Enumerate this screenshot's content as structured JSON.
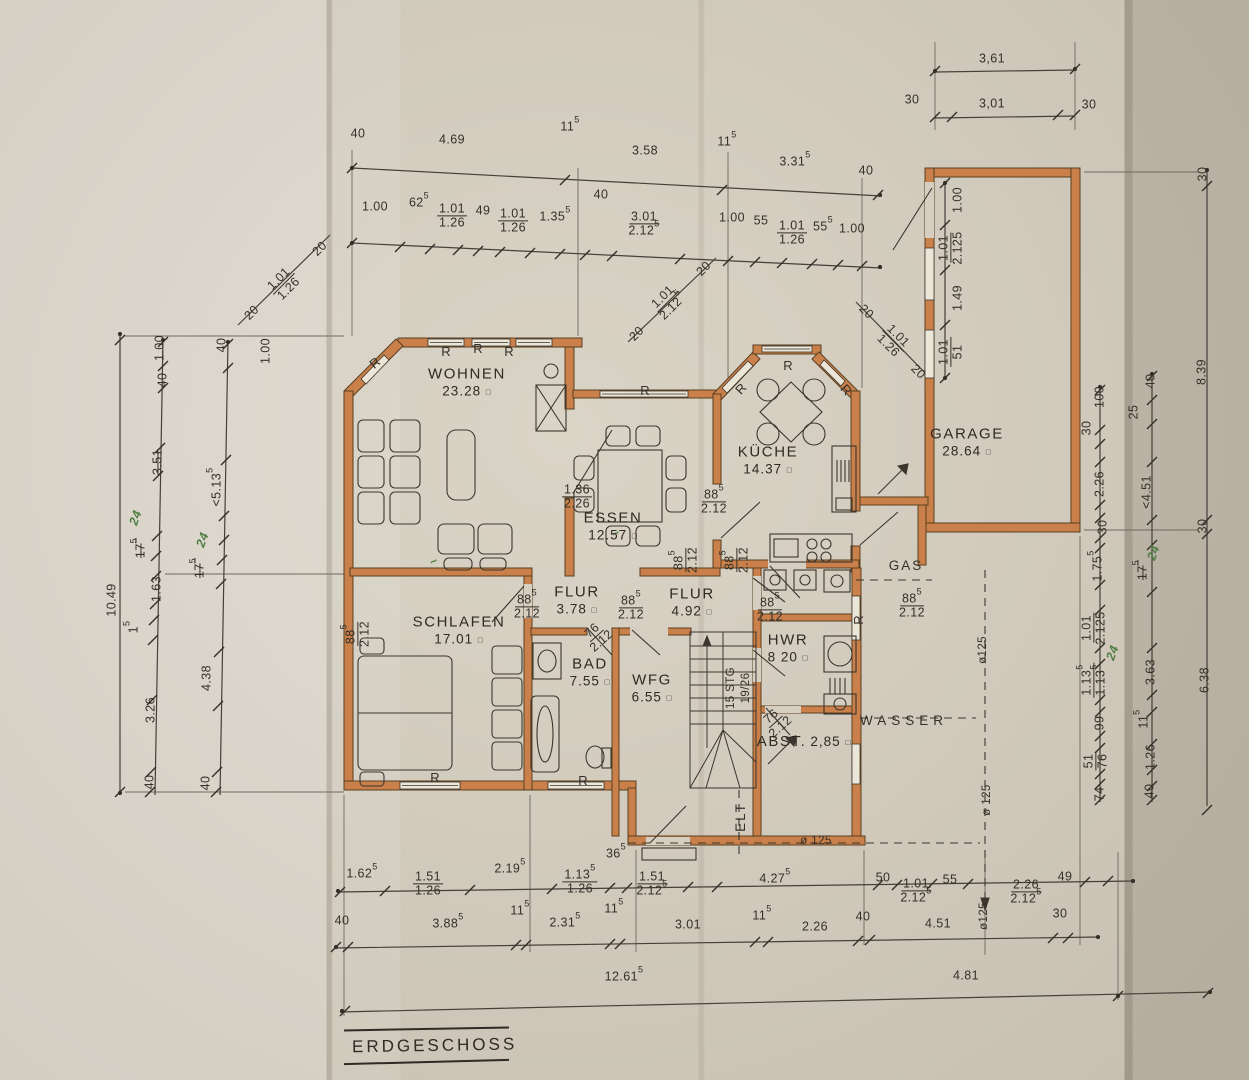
{
  "title": {
    "text": "ERDGESCHOSS"
  },
  "colors": {
    "paper": "#d6cfc1",
    "wall": "#c9804a",
    "wall_edge": "#5a4020",
    "ink": "#34302a",
    "hand_green": "#4e7d44"
  },
  "rooms": [
    {
      "n": "WOHNEN",
      "a": "23.28",
      "x": 467,
      "y": 382
    },
    {
      "n": "ESSEN",
      "a": "12.57",
      "x": 613,
      "y": 526
    },
    {
      "n": "KÜCHE",
      "a": "14.37",
      "x": 768,
      "y": 460
    },
    {
      "n": "GARAGE",
      "a": "28.64",
      "x": 967,
      "y": 442
    },
    {
      "n": "SCHLAFEN",
      "a": "17.01",
      "x": 459,
      "y": 630
    },
    {
      "n": "FLUR",
      "a": "3.78",
      "x": 577,
      "y": 600
    },
    {
      "n": "FLUR",
      "a": "4.92",
      "x": 692,
      "y": 602
    },
    {
      "n": "BAD",
      "a": "7.55",
      "x": 590,
      "y": 672
    },
    {
      "n": "WFG",
      "a": "6.55",
      "x": 652,
      "y": 688
    },
    {
      "n": "HWR",
      "a": "8 20",
      "x": 788,
      "y": 648
    },
    {
      "n": "ABST.",
      "a": "2,85",
      "x": 806,
      "y": 742,
      "inline": true
    }
  ],
  "dim_labels": [
    [
      "3,61",
      992,
      59
    ],
    [
      "30",
      912,
      100
    ],
    [
      "3,01",
      992,
      104
    ],
    [
      "30",
      1089,
      105
    ],
    [
      "40",
      358,
      134
    ],
    [
      "4.69",
      452,
      140
    ],
    [
      "11^5",
      570,
      127
    ],
    [
      "3.58",
      645,
      151
    ],
    [
      "11^5",
      727,
      142
    ],
    [
      "3.31^5",
      795,
      162
    ],
    [
      "40",
      866,
      171
    ],
    [
      "1.00",
      375,
      207
    ],
    [
      "62^5",
      419,
      203
    ],
    [
      "49",
      483,
      211
    ],
    [
      "1.35^5",
      555,
      217
    ],
    [
      "40",
      601,
      195
    ],
    [
      "1.00",
      732,
      218
    ],
    [
      "55",
      761,
      221
    ],
    [
      "55^5",
      823,
      227
    ],
    [
      "1.00",
      852,
      229
    ],
    [
      "1.00",
      958,
      200,
      -90
    ],
    [
      "1.49",
      958,
      298,
      -90
    ],
    [
      "10.49",
      112,
      600,
      -90
    ],
    [
      "1.00",
      160,
      348,
      -90
    ],
    [
      "40",
      163,
      380,
      -90
    ],
    [
      "3.51",
      158,
      462,
      -90,
      "strike"
    ],
    [
      "24",
      136,
      518,
      -70,
      "hand"
    ],
    [
      "17^5",
      141,
      548,
      -90,
      "strike"
    ],
    [
      "1.63",
      157,
      589,
      -90
    ],
    [
      "1^5",
      134,
      627,
      -90
    ],
    [
      "3.26",
      151,
      710,
      -90
    ],
    [
      "40",
      150,
      782,
      -90
    ],
    [
      "40",
      222,
      345,
      -90
    ],
    [
      "1.00",
      266,
      351,
      -90
    ],
    [
      "<5.13^5",
      217,
      487,
      -90
    ],
    [
      "24",
      203,
      540,
      -70,
      "hand"
    ],
    [
      "17^5",
      200,
      568,
      -90,
      "strike"
    ],
    [
      "4.38",
      207,
      678,
      -90
    ],
    [
      "40",
      206,
      783,
      -90
    ],
    [
      "100",
      1100,
      397,
      -90
    ],
    [
      "30",
      1087,
      428,
      -90
    ],
    [
      "2.26",
      1100,
      484,
      -90
    ],
    [
      "30",
      1103,
      527,
      -90
    ],
    [
      "1.75^5",
      1098,
      566,
      -90
    ],
    [
      "24",
      1113,
      653,
      -70,
      "hand"
    ],
    [
      "99",
      1100,
      723,
      -90
    ],
    [
      "74",
      1100,
      794,
      -90
    ],
    [
      "40",
      1151,
      381,
      -90
    ],
    [
      "25",
      1134,
      412,
      -90
    ],
    [
      "<4.51",
      1147,
      492,
      -90
    ],
    [
      "24",
      1154,
      553,
      -70,
      "hand"
    ],
    [
      "17^5",
      1143,
      570,
      -90,
      "strike"
    ],
    [
      "3.63",
      1151,
      672,
      -90
    ],
    [
      "11^5",
      1144,
      719,
      -90
    ],
    [
      "1.26",
      1151,
      757,
      -90
    ],
    [
      "40",
      1150,
      791,
      -90
    ],
    [
      "30",
      1203,
      174,
      -90
    ],
    [
      "8.39",
      1202,
      372,
      -90
    ],
    [
      "30",
      1203,
      526,
      -90
    ],
    [
      "6.38",
      1205,
      680,
      -90
    ],
    [
      "1.62^5",
      362,
      874
    ],
    [
      "2.19^5",
      510,
      869
    ],
    [
      "36^5",
      616,
      854
    ],
    [
      "4.27^5",
      775,
      879
    ],
    [
      "50",
      883,
      878
    ],
    [
      "55",
      950,
      880
    ],
    [
      "49",
      1065,
      877
    ],
    [
      "40",
      342,
      921
    ],
    [
      "3.88^5",
      448,
      924
    ],
    [
      "11^5",
      520,
      911
    ],
    [
      "2.31^5",
      565,
      923
    ],
    [
      "11^5",
      614,
      909
    ],
    [
      "3.01",
      688,
      925
    ],
    [
      "11^5",
      762,
      916
    ],
    [
      "2.26",
      815,
      927
    ],
    [
      "40",
      863,
      917
    ],
    [
      "4.51",
      938,
      924
    ],
    [
      "30",
      1060,
      914
    ],
    [
      "12.61^5",
      624,
      977
    ],
    [
      "4.81",
      966,
      976
    ],
    [
      "20",
      252,
      313,
      -45
    ],
    [
      "20",
      320,
      249,
      -45
    ],
    [
      "20",
      637,
      334,
      -45
    ],
    [
      "20",
      704,
      269,
      -45
    ],
    [
      "20",
      866,
      312,
      45
    ],
    [
      "20",
      918,
      372,
      45
    ],
    [
      "GAS",
      906,
      566,
      0,
      "util"
    ],
    [
      "WASSER",
      904,
      721,
      0,
      "util wide"
    ],
    [
      "ELT",
      741,
      817,
      -90,
      "util"
    ],
    [
      "ø 125",
      816,
      841,
      0,
      "small"
    ],
    [
      "ø125",
      983,
      650,
      -90,
      "small"
    ],
    [
      "ø 125",
      987,
      800,
      -90,
      "small"
    ],
    [
      "ø125",
      984,
      916,
      -90,
      "small"
    ],
    [
      "15 STG",
      731,
      688,
      -90,
      "small"
    ],
    [
      "19/26",
      746,
      688,
      -90,
      "small"
    ],
    [
      "R",
      446,
      352,
      0,
      "rm"
    ],
    [
      "R",
      478,
      349,
      0,
      "rm"
    ],
    [
      "R",
      509,
      352,
      0,
      "rm"
    ],
    [
      "R",
      375,
      363,
      -40,
      "rm"
    ],
    [
      "R",
      645,
      391,
      0,
      "rm"
    ],
    [
      "R",
      741,
      389,
      -48,
      "rm"
    ],
    [
      "R",
      788,
      366,
      0,
      "rm"
    ],
    [
      "R",
      846,
      390,
      48,
      "rm"
    ],
    [
      "R",
      435,
      778,
      0,
      "rm"
    ],
    [
      "R",
      583,
      781,
      0,
      "rm"
    ],
    [
      "R",
      859,
      620,
      -90,
      "rm"
    ],
    [
      "~",
      434,
      562,
      -30,
      "hand"
    ],
    [
      "~",
      616,
      534,
      -30,
      "hand"
    ]
  ],
  "fracs": [
    [
      "1.01",
      "1.26",
      452,
      216
    ],
    [
      "1.01",
      "1.26",
      513,
      221
    ],
    [
      "3.01",
      "2.12^5",
      644,
      224
    ],
    [
      "1.01",
      "1.26",
      792,
      233
    ],
    [
      "1.01",
      "2.125",
      951,
      248,
      -90
    ],
    [
      "1.01",
      "51",
      951,
      352,
      -90
    ],
    [
      "1.01",
      "1.26",
      284,
      284,
      -45
    ],
    [
      "1.01",
      "2.12^5",
      668,
      302,
      -45
    ],
    [
      "1.01",
      "1.26",
      893,
      341,
      45
    ],
    [
      "1.01",
      "2.125",
      1094,
      628,
      -90
    ],
    [
      "1.13^5",
      "1.13^5",
      1094,
      680,
      -90
    ],
    [
      "51",
      "76",
      1096,
      761,
      -90
    ],
    [
      "1.51",
      "1.26",
      428,
      884
    ],
    [
      "1.13^5",
      "1.26",
      580,
      882
    ],
    [
      "1.51",
      "2.12^5",
      652,
      884
    ],
    [
      "1.01",
      "2.12^5",
      916,
      891
    ],
    [
      "2.26",
      "2.12^5",
      1026,
      892
    ],
    [
      "1.36",
      "2.26",
      577,
      497
    ],
    [
      "88^5",
      "2.12",
      714,
      502
    ],
    [
      "88^5",
      "2.12",
      686,
      560,
      -90
    ],
    [
      "88^5",
      "2.12",
      737,
      560,
      -90
    ],
    [
      "88^5",
      "2.12",
      527,
      607
    ],
    [
      "88^5",
      "2.12",
      631,
      608
    ],
    [
      "88^5",
      "2.12",
      770,
      610
    ],
    [
      "88^5",
      "2.12",
      912,
      606
    ],
    [
      "76",
      "2.12",
      597,
      636,
      -42
    ],
    [
      "76",
      "2.12",
      776,
      722,
      -42
    ],
    [
      "88^5",
      "2.12",
      358,
      634,
      -90
    ]
  ],
  "ticks": [
    [
      352,
      168
    ],
    [
      565,
      180
    ],
    [
      722,
      190
    ],
    [
      878,
      195
    ],
    [
      352,
      243
    ],
    [
      400,
      247
    ],
    [
      430,
      249
    ],
    [
      458,
      250
    ],
    [
      478,
      251
    ],
    [
      500,
      252
    ],
    [
      530,
      253
    ],
    [
      560,
      254
    ],
    [
      585,
      255
    ],
    [
      612,
      256
    ],
    [
      680,
      259
    ],
    [
      728,
      261
    ],
    [
      755,
      262
    ],
    [
      782,
      263
    ],
    [
      812,
      264
    ],
    [
      838,
      265
    ],
    [
      862,
      266
    ],
    [
      935,
      71
    ],
    [
      1075,
      69
    ],
    [
      935,
      117
    ],
    [
      952,
      117
    ],
    [
      1058,
      115
    ],
    [
      1075,
      115
    ],
    [
      945,
      183
    ],
    [
      945,
      225
    ],
    [
      945,
      270
    ],
    [
      945,
      325
    ],
    [
      945,
      378
    ],
    [
      120,
      340
    ],
    [
      120,
      792
    ],
    [
      163,
      342
    ],
    [
      163,
      366
    ],
    [
      163,
      388
    ],
    [
      160,
      448
    ],
    [
      158,
      476
    ],
    [
      157,
      536
    ],
    [
      156,
      556
    ],
    [
      156,
      576
    ],
    [
      155,
      604
    ],
    [
      154,
      620
    ],
    [
      153,
      640
    ],
    [
      152,
      700
    ],
    [
      151,
      772
    ],
    [
      150,
      792
    ],
    [
      228,
      344
    ],
    [
      228,
      368
    ],
    [
      226,
      460
    ],
    [
      224,
      516
    ],
    [
      224,
      540
    ],
    [
      222,
      560
    ],
    [
      221,
      584
    ],
    [
      219,
      652
    ],
    [
      218,
      706
    ],
    [
      217,
      772
    ],
    [
      216,
      792
    ],
    [
      1100,
      390
    ],
    [
      1100,
      430
    ],
    [
      1100,
      444
    ],
    [
      1100,
      462
    ],
    [
      1100,
      505
    ],
    [
      1100,
      518
    ],
    [
      1100,
      538
    ],
    [
      1100,
      548
    ],
    [
      1100,
      585
    ],
    [
      1100,
      610
    ],
    [
      1100,
      648
    ],
    [
      1100,
      664
    ],
    [
      1100,
      700
    ],
    [
      1100,
      712
    ],
    [
      1100,
      736
    ],
    [
      1100,
      748
    ],
    [
      1100,
      774
    ],
    [
      1100,
      784
    ],
    [
      1100,
      800
    ],
    [
      1152,
      376
    ],
    [
      1152,
      400
    ],
    [
      1152,
      424
    ],
    [
      1152,
      462
    ],
    [
      1152,
      520
    ],
    [
      1152,
      545
    ],
    [
      1152,
      592
    ],
    [
      1152,
      648
    ],
    [
      1152,
      695
    ],
    [
      1152,
      712
    ],
    [
      1152,
      744
    ],
    [
      1152,
      770
    ],
    [
      1152,
      786
    ],
    [
      1152,
      800
    ],
    [
      1207,
      186
    ],
    [
      1207,
      520
    ],
    [
      1207,
      534
    ],
    [
      1207,
      810
    ],
    [
      340,
      892
    ],
    [
      385,
      891
    ],
    [
      470,
      890
    ],
    [
      552,
      889
    ],
    [
      610,
      888
    ],
    [
      627,
      888
    ],
    [
      688,
      887
    ],
    [
      717,
      887
    ],
    [
      878,
      885
    ],
    [
      897,
      885
    ],
    [
      932,
      884
    ],
    [
      968,
      884
    ],
    [
      1085,
      882
    ],
    [
      1108,
      881
    ],
    [
      336,
      947
    ],
    [
      348,
      947
    ],
    [
      516,
      945
    ],
    [
      526,
      945
    ],
    [
      610,
      944
    ],
    [
      620,
      944
    ],
    [
      755,
      942
    ],
    [
      768,
      942
    ],
    [
      858,
      941
    ],
    [
      870,
      940
    ],
    [
      1053,
      938
    ],
    [
      1068,
      938
    ],
    [
      345,
      1011
    ],
    [
      1118,
      996
    ],
    [
      1208,
      993
    ]
  ],
  "dots": [
    [
      352,
      168
    ],
    [
      880,
      195
    ],
    [
      352,
      243
    ],
    [
      880,
      267
    ],
    [
      935,
      71
    ],
    [
      1075,
      69
    ],
    [
      120,
      334
    ],
    [
      120,
      793
    ],
    [
      163,
      340
    ],
    [
      228,
      342
    ],
    [
      1100,
      387
    ],
    [
      1152,
      374
    ],
    [
      1207,
      170
    ],
    [
      338,
      891
    ],
    [
      1133,
      881
    ],
    [
      336,
      947
    ],
    [
      1098,
      937
    ],
    [
      342,
      1011
    ],
    [
      1118,
      996
    ],
    [
      1210,
      992
    ],
    [
      945,
      183
    ],
    [
      945,
      378
    ]
  ]
}
